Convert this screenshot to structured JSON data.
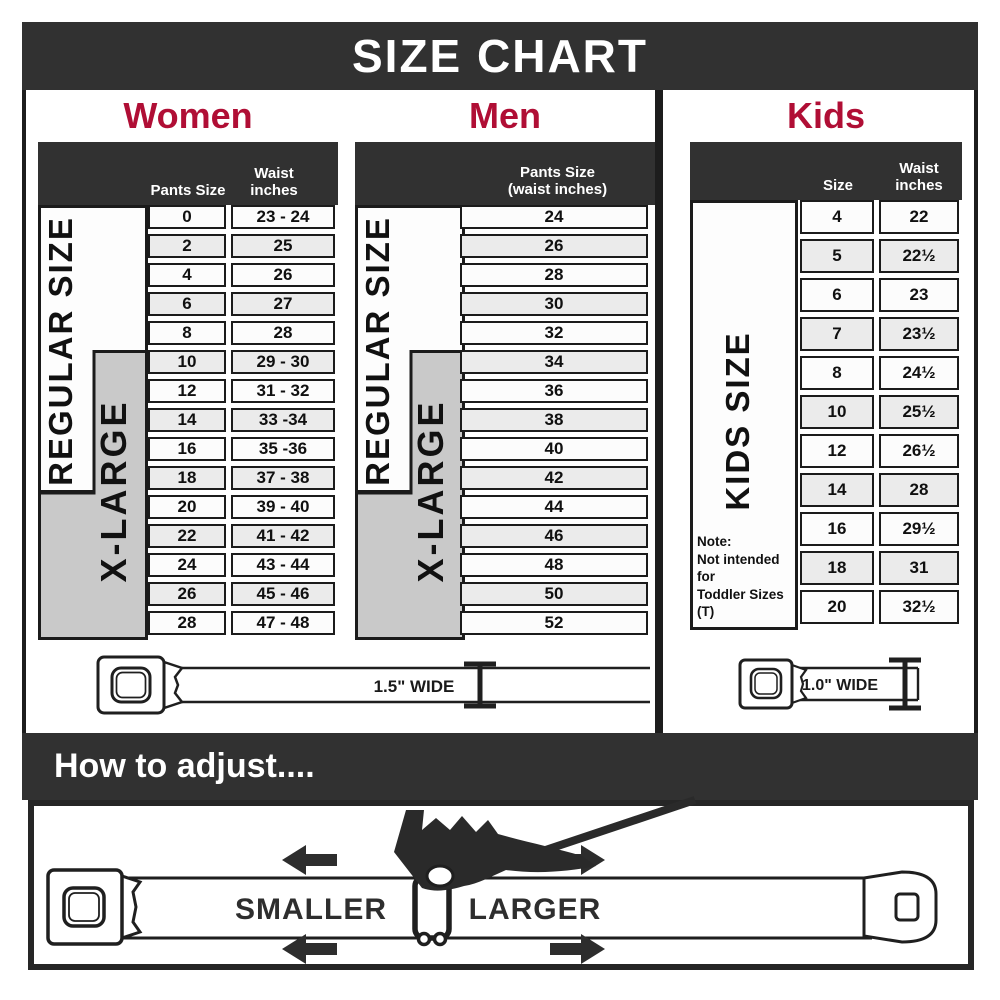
{
  "page": {
    "title": "SIZE CHART",
    "adjust_heading": "How to adjust...."
  },
  "colors": {
    "banner_dark": "#313131",
    "accent_red": "#B00E35",
    "xlarge_gray": "#C9C9C9",
    "cell_border": "#1B1B1B"
  },
  "women": {
    "title": "Women",
    "header": {
      "pants": "Pants Size",
      "waist": "Waist inches"
    },
    "regular_label": "REGULAR SIZE",
    "xlarge_label": "X-LARGE",
    "belt_width_label": "1.5\" WIDE",
    "rows": [
      {
        "size": "0",
        "waist": "23 - 24"
      },
      {
        "size": "2",
        "waist": "25"
      },
      {
        "size": "4",
        "waist": "26"
      },
      {
        "size": "6",
        "waist": "27"
      },
      {
        "size": "8",
        "waist": "28"
      },
      {
        "size": "10",
        "waist": "29 - 30"
      },
      {
        "size": "12",
        "waist": "31 - 32"
      },
      {
        "size": "14",
        "waist": "33 -34"
      },
      {
        "size": "16",
        "waist": "35 -36"
      },
      {
        "size": "18",
        "waist": "37 - 38"
      },
      {
        "size": "20",
        "waist": "39 - 40"
      },
      {
        "size": "22",
        "waist": "41 - 42"
      },
      {
        "size": "24",
        "waist": "43 - 44"
      },
      {
        "size": "26",
        "waist": "45 - 46"
      },
      {
        "size": "28",
        "waist": "47 - 48"
      }
    ]
  },
  "men": {
    "title": "Men",
    "header_line1": "Pants Size",
    "header_line2": "(waist inches)",
    "regular_label": "REGULAR SIZE",
    "xlarge_label": "X-LARGE",
    "rows": [
      "24",
      "26",
      "28",
      "30",
      "32",
      "34",
      "36",
      "38",
      "40",
      "42",
      "44",
      "46",
      "48",
      "50",
      "52"
    ]
  },
  "kids": {
    "title": "Kids",
    "header": {
      "size": "Size",
      "waist": "Waist inches"
    },
    "side_label": "KIDS SIZE",
    "belt_width_label": "1.0\" WIDE",
    "note_line1": "Note:",
    "note_line2": "Not intended for",
    "note_line3": "Toddler Sizes (T)",
    "rows": [
      {
        "size": "4",
        "waist": "22"
      },
      {
        "size": "5",
        "waist": "22½"
      },
      {
        "size": "6",
        "waist": "23"
      },
      {
        "size": "7",
        "waist": "23½"
      },
      {
        "size": "8",
        "waist": "24½"
      },
      {
        "size": "10",
        "waist": "25½"
      },
      {
        "size": "12",
        "waist": "26½"
      },
      {
        "size": "14",
        "waist": "28"
      },
      {
        "size": "16",
        "waist": "29½"
      },
      {
        "size": "18",
        "waist": "31"
      },
      {
        "size": "20",
        "waist": "32½"
      }
    ]
  },
  "adjust": {
    "smaller": "SMALLER",
    "larger": "LARGER"
  }
}
